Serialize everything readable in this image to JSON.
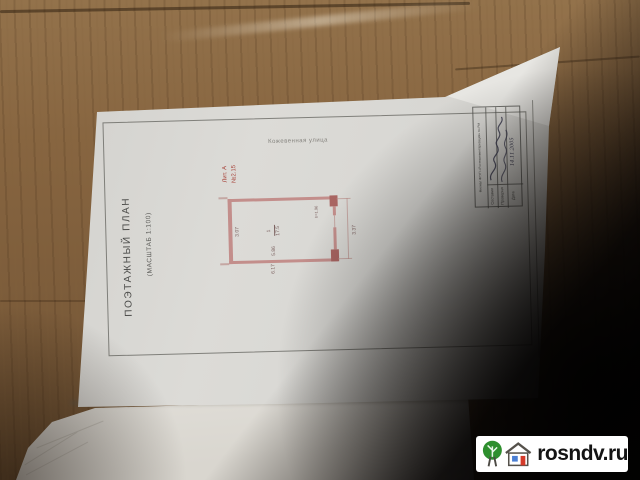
{
  "watermark": {
    "text": "rosndv.ru"
  },
  "document": {
    "title": "ПОЭТАЖНЫЙ ПЛАН",
    "scale_note": "(МАСШТАБ  1:100)",
    "street_label": "Кожевенная улица",
    "red_marks": {
      "line1": "Лит. А",
      "line2": "№2.15"
    },
    "plan": {
      "room_number": "1",
      "room_area": "17.5",
      "dims": {
        "width_inner": "3.07",
        "height_inner": "5.86",
        "height_outer": "6.17",
        "width_outer": "3.37",
        "opening": "h=1.96"
      }
    },
    "stamp": {
      "org": "Филиал ФГУП «Ростехинвентаризация» по РМ",
      "rows": [
        {
          "label": "Составил"
        },
        {
          "label": "Проверил"
        },
        {
          "label": "Дата"
        }
      ],
      "handwritten_date": "14.11.2005"
    }
  },
  "colors": {
    "wood": "#8a6a45",
    "paper": "#d9d8d4",
    "plan_walls": "#c38e8b",
    "red_ink": "#a8453c",
    "shadow": "#0a0705",
    "watermark_tree_green": "#2e8f2e",
    "watermark_window_blue": "#4a7fd4",
    "watermark_door_red": "#d43a2a"
  }
}
